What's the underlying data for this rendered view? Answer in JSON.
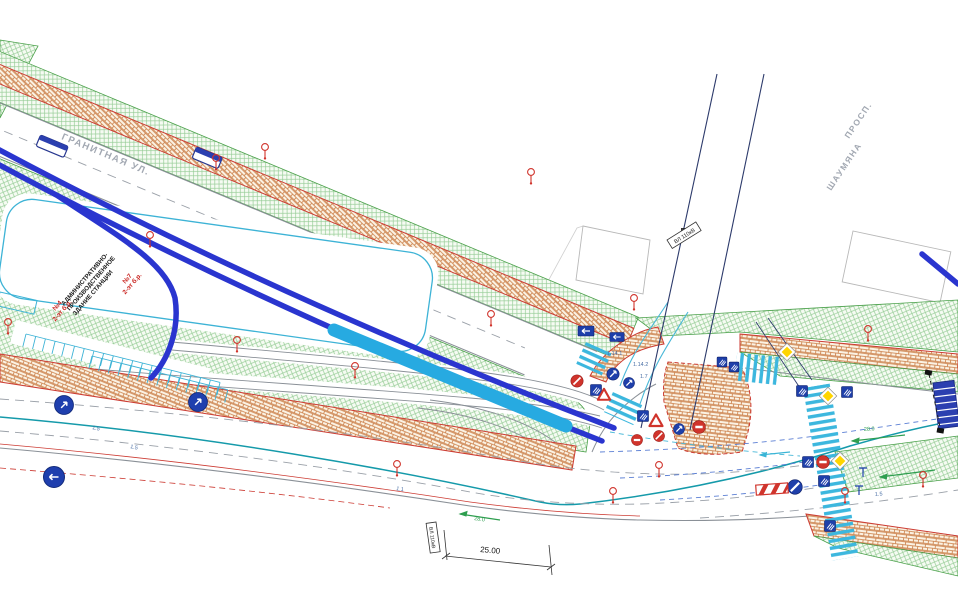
{
  "plan": {
    "title": "traffic-engineering-site-plan",
    "streets": {
      "granitnaya": "ГРАНИТНАЯ УЛ.",
      "prospekt_line1": "ПРОСП.",
      "prospekt_line2": "ШАУМЯНА"
    },
    "building": {
      "line1": "АДМИНИСТРАТИВНО-",
      "line2": "ПРОИЗВОДСТВЕННОЕ",
      "line3": "ЗДАНИЕ СТАНЦИИ",
      "no7": "№7",
      "no7_floors": "2-эт б.р.",
      "no4": "№4",
      "no4_floors": "2-эт б.р."
    },
    "labels": {
      "power_line": "ВЛ 110кВ",
      "dimension": "25.00"
    },
    "markings": {
      "m15": "1.5",
      "m11": "1.1",
      "m17": "1.7",
      "m1141": "1.14.1",
      "m1142": "1.14.2",
      "m28": "28.0"
    },
    "legend_icons": {
      "pedestrian_crossing_sign": "blue-square",
      "direction_info_sign": "blue-rect-arrow",
      "mandatory_direction_sign": "blue-circle-arrow",
      "priority_road_sign": "yellow-diamond",
      "give_way_sign": "red-triangle",
      "no_entry_sign": "red-circle-bar",
      "restriction_sign": "red-circle-slash",
      "existing_sign_post": "red-lollipop",
      "bus_shelter": "blue-rect",
      "safety_barrier": "red-white-stripes",
      "power_pole": "black-square-x",
      "section_marker": "black-squares-dashed"
    },
    "colors": {
      "route_blue": "#2a35cf",
      "platform_cyan": "#27aae1",
      "zebra_cyan": "#3cb7de",
      "lawn_hatch": "#97cd97",
      "paver_line": "#c97b43",
      "curb_red": "#cc3b33",
      "sign_blue": "#1e3faa",
      "warning_yellow": "#ffd500",
      "sign_red": "#d0342c",
      "marking_teal": "#159aaa",
      "marking_green": "#2e9e4f",
      "powerline_navy": "#2c3a6b",
      "street_text_gray": "#a2a8b2"
    }
  }
}
